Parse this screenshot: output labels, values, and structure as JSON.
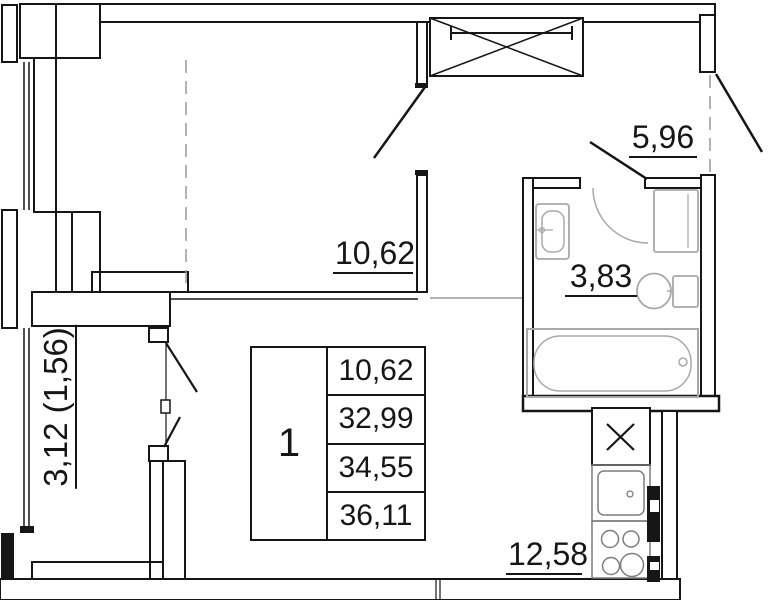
{
  "labels": {
    "living_area": "10,62",
    "hall_area": "5,96",
    "bathroom_area": "3,83",
    "kitchen_area": "12,58",
    "balcony_area": "3,12 (1,56)"
  },
  "info_table": {
    "room_number": "1",
    "rows": [
      "10,62",
      "32,99",
      "34,55",
      "36,11"
    ]
  },
  "colors": {
    "line": "#161616",
    "fixture": "#a8a8a8",
    "fixture_dark": "#7d7d7d",
    "dashed": "#9a9a9a",
    "background": "#ffffff"
  }
}
